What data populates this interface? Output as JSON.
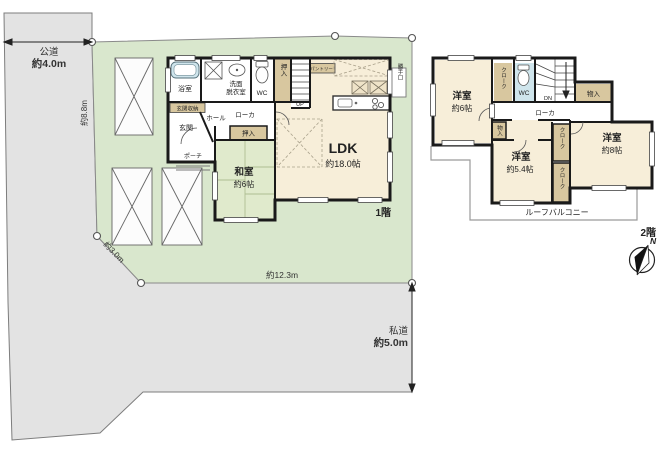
{
  "site": {
    "public_road_label": "公道",
    "public_road_size": "約4.0m",
    "private_road_label": "私道",
    "private_road_size": "約5.0m",
    "dim_west": "約8.8m",
    "dim_southwest": "約3.0m",
    "dim_south": "約12.3m"
  },
  "floor1": {
    "floor_label": "1階",
    "ldk_label": "LDK",
    "ldk_size": "約18.0帖",
    "washitsu_label": "和室",
    "washitsu_size": "約6帖",
    "bath_label": "浴室",
    "wash_line1": "洗面",
    "wash_line2": "脱衣室",
    "wc_label": "WC",
    "oshiire_top_label": "押入",
    "oshiire_side_label": "押入",
    "stairs_label": "UP",
    "genkan_storage_label": "玄関収納",
    "genkan_label": "玄関",
    "hall_label": "ホール",
    "roka_label": "ローカ",
    "porch_label": "ポーチ",
    "pantry_label": "パントリー",
    "backdoor_label": "勝手口"
  },
  "floor2": {
    "floor_label": "2階",
    "west_room_label": "洋室",
    "west_room_size": "約6帖",
    "middle_room_label": "洋室",
    "middle_room_size": "約5.4帖",
    "east_room_label": "洋室",
    "east_room_size": "約8帖",
    "cloak_top_label": "クローク",
    "cloak_mid_label": "クローク",
    "cloak_bottom_label": "クローク",
    "wc_label": "WC",
    "stairs_label": "DN",
    "storage_top_label": "物入",
    "storage_side_label": "物入",
    "roka_label": "ローカ",
    "balcony_label": "ルーフバルコニー"
  },
  "compass": {
    "north_label": "N"
  },
  "colors": {
    "site_green": "#d9e7cd",
    "road_gray": "#e3e3e3",
    "room_cream": "#f7eed9",
    "closet_tan": "#d8c79f",
    "wet_blue": "#cfe5ec",
    "tatami_green": "#e0eacc",
    "wall_black": "#1a1a1a"
  }
}
